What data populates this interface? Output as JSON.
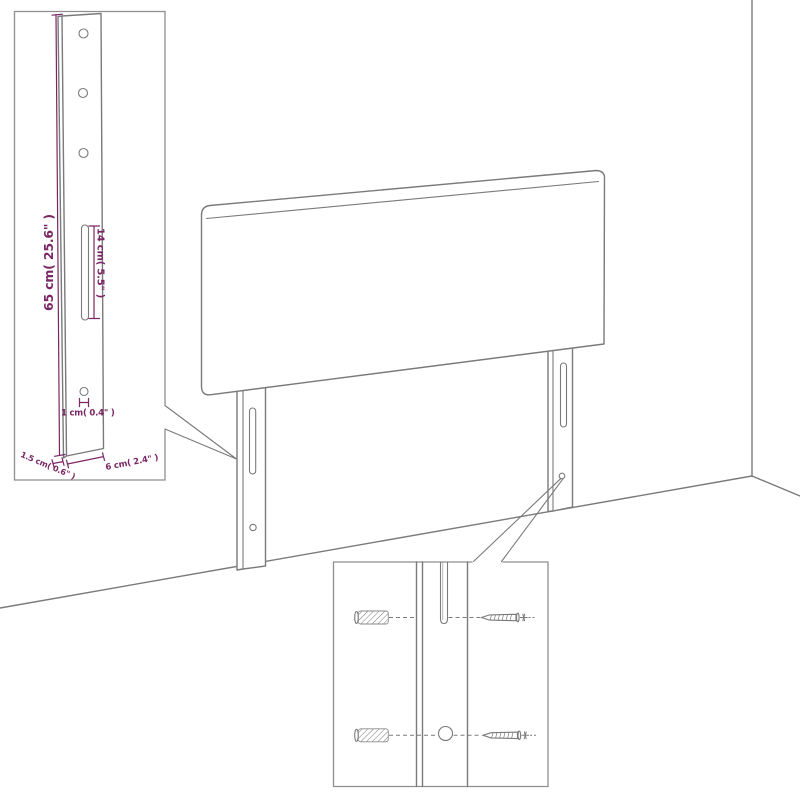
{
  "diagram": {
    "type": "product-dimension-diagram",
    "subject": "upholstered headboard with two mounting legs shown against a wall corner, with magnified leg detail and wall-anchor/screw hardware detail",
    "colors": {
      "background": "#ffffff",
      "line": "#7a7a7a",
      "inset_border": "#8f8f8f",
      "dimension": "#7b2664"
    },
    "labels": {
      "height": "65 cm( 25.6\" )",
      "slot_length": "14 cm( 5.5\" )",
      "hole_diameter": "1 cm( 0.4\" )",
      "thickness": "1.5 cm( 0.6\" )",
      "width": "6 cm( 2.4\" )"
    }
  }
}
